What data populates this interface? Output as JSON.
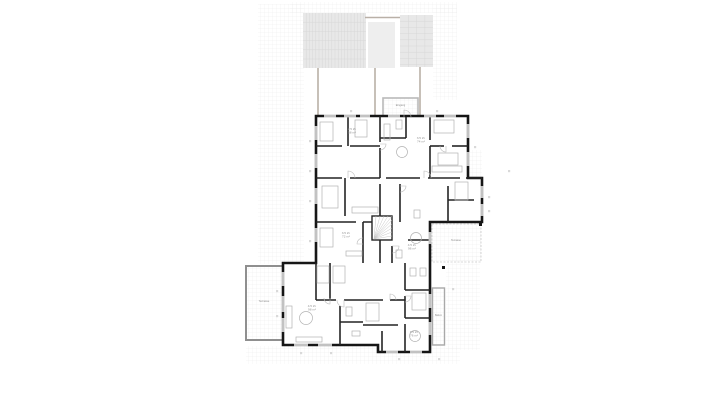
{
  "page": {
    "background": "#ffffff",
    "title": "floor-plan"
  },
  "drawing": {
    "canvas": {
      "width": 721,
      "height": 405
    },
    "colors": {
      "wall": "#161616",
      "interior_wall": "#242424",
      "furniture": "#b3b3b3",
      "paving_line": "#e9e9e9",
      "pergola_fill": "#e8e8e8",
      "pergola_line": "#d7d7d7",
      "pergola_mid_fill": "#eeeeee",
      "support_line": "#b9b0a7",
      "window_line": "#9a9a9a",
      "door_line": "#bbbbbb",
      "label": "#8f8f8f",
      "dim_mark": "#d9d9d9"
    },
    "paving_patches": [
      [
        290,
        2,
        167,
        11
      ],
      [
        258,
        4,
        46,
        260
      ],
      [
        433,
        5,
        24,
        95
      ],
      [
        246,
        346,
        214,
        18
      ],
      [
        446,
        256,
        34,
        94
      ],
      [
        468,
        150,
        14,
        28
      ]
    ],
    "pergolas": [
      {
        "x": 303,
        "y": 13,
        "w": 63,
        "h": 55,
        "vs": 3.2,
        "hs": 9.2
      },
      {
        "x": 368,
        "y": 22,
        "w": 27,
        "h": 46,
        "vs": 0,
        "hs": 0
      },
      {
        "x": 400,
        "y": 15,
        "w": 33,
        "h": 52,
        "vs": 8.3,
        "hs": 6.2
      }
    ],
    "connector_line": [
      365,
      17.5,
      400,
      17.5
    ],
    "support_lines": [
      [
        318,
        68,
        318,
        116
      ],
      [
        375,
        68,
        375,
        118
      ],
      [
        420,
        67,
        420,
        118
      ]
    ],
    "porch": {
      "x": 383,
      "y": 98,
      "w": 35,
      "h": 19
    },
    "terraces": [
      {
        "x": 246,
        "y": 266,
        "w": 37,
        "h": 74,
        "stroke": "#8f8f8f",
        "sw": 2,
        "dash": ""
      },
      {
        "x": 432,
        "y": 224,
        "w": 49,
        "h": 38,
        "stroke": "#cccccc",
        "sw": 0.8,
        "dash": "2 1.5"
      },
      {
        "x": 432.5,
        "y": 288,
        "w": 12,
        "h": 57,
        "stroke": "#a9a9a9",
        "sw": 1.4,
        "dash": ""
      }
    ],
    "footprint": "316,116 468,116 468,178 482,178 482,222 430,222 430,352 378,352 378,345 283,345 283,263 316,263",
    "interior_walls": [
      [
        348,
        116,
        348,
        146
      ],
      [
        316,
        146,
        342,
        146
      ],
      [
        350,
        146,
        380,
        146
      ],
      [
        316,
        178,
        342,
        178
      ],
      [
        350,
        178,
        380,
        178
      ],
      [
        345,
        178,
        345,
        216
      ],
      [
        316,
        222,
        356,
        222
      ],
      [
        363,
        222,
        380,
        222
      ],
      [
        363,
        222,
        363,
        263
      ],
      [
        380,
        116,
        380,
        142
      ],
      [
        380,
        148,
        380,
        178
      ],
      [
        380,
        184,
        380,
        222
      ],
      [
        380,
        228,
        380,
        263
      ],
      [
        406,
        117,
        406,
        138
      ],
      [
        380,
        138,
        406,
        138
      ],
      [
        430,
        117,
        430,
        140
      ],
      [
        430,
        146,
        430,
        178
      ],
      [
        430,
        146,
        444,
        146
      ],
      [
        452,
        146,
        468,
        146
      ],
      [
        386,
        178,
        420,
        178
      ],
      [
        428,
        178,
        460,
        178
      ],
      [
        466,
        178,
        482,
        178
      ],
      [
        400,
        184,
        400,
        222
      ],
      [
        448,
        186,
        448,
        222
      ],
      [
        448,
        200,
        474,
        200
      ],
      [
        392,
        246,
        392,
        263
      ],
      [
        408,
        240,
        430,
        240
      ],
      [
        330,
        263,
        330,
        300
      ],
      [
        316,
        263,
        316,
        300
      ],
      [
        316,
        300,
        336,
        300
      ],
      [
        344,
        300,
        363,
        300
      ],
      [
        340,
        306,
        340,
        345
      ],
      [
        340,
        322,
        363,
        322
      ],
      [
        405,
        263,
        405,
        290
      ],
      [
        405,
        296,
        405,
        318
      ],
      [
        405,
        324,
        405,
        352
      ],
      [
        405,
        290,
        430,
        290
      ],
      [
        405,
        318,
        430,
        318
      ],
      [
        363,
        300,
        383,
        300
      ],
      [
        390,
        300,
        405,
        300
      ],
      [
        363,
        325,
        398,
        325
      ],
      [
        382,
        331,
        382,
        352
      ]
    ],
    "windows": [
      [
        324,
        114.7,
        12,
        2.6
      ],
      [
        344,
        114.7,
        12,
        2.6
      ],
      [
        360,
        114.7,
        10,
        2.6
      ],
      [
        388,
        114.7,
        12,
        2.6
      ],
      [
        424,
        114.7,
        12,
        2.6
      ],
      [
        444,
        114.7,
        12,
        2.6
      ],
      [
        466.7,
        124,
        2.6,
        14
      ],
      [
        466.7,
        152,
        2.6,
        14
      ],
      [
        480.7,
        186,
        2.6,
        12
      ],
      [
        480.7,
        204,
        2.6,
        12
      ],
      [
        314.7,
        126,
        2.6,
        14
      ],
      [
        314.7,
        154,
        2.6,
        14
      ],
      [
        314.7,
        188,
        2.6,
        16
      ],
      [
        314.7,
        228,
        2.6,
        14
      ],
      [
        281.7,
        272,
        2.6,
        14
      ],
      [
        281.7,
        296,
        2.6,
        16
      ],
      [
        281.7,
        318,
        2.6,
        14
      ],
      [
        294,
        343.7,
        14,
        2.6
      ],
      [
        318,
        343.7,
        14,
        2.6
      ],
      [
        386,
        350.7,
        12,
        2.6
      ],
      [
        410,
        350.7,
        12,
        2.6
      ],
      [
        428.7,
        232,
        2.6,
        12
      ],
      [
        428.7,
        294,
        2.6,
        14
      ],
      [
        428.7,
        322,
        2.6,
        13
      ]
    ],
    "doors": [
      [
        348,
        178,
        7,
        0
      ],
      [
        424,
        178,
        7,
        0
      ],
      [
        446,
        146,
        6,
        180
      ],
      [
        400,
        186,
        6,
        90
      ],
      [
        392,
        246,
        7,
        90
      ],
      [
        344,
        300,
        7,
        180
      ],
      [
        390,
        300,
        6,
        0
      ],
      [
        405,
        296,
        6,
        90
      ],
      [
        404,
        117,
        7,
        0
      ],
      [
        363,
        244,
        6,
        270
      ],
      [
        330,
        298,
        6,
        180
      ],
      [
        380,
        144,
        6,
        90
      ]
    ],
    "stair": {
      "x": 372,
      "y": 216,
      "w": 20,
      "h": 24,
      "cx": 374,
      "cy": 239,
      "rays": 10
    },
    "furniture_rects": [
      [
        320,
        122,
        13,
        19
      ],
      [
        355,
        120,
        12,
        17
      ],
      [
        434,
        120,
        20,
        13
      ],
      [
        438,
        153,
        20,
        12
      ],
      [
        322,
        186,
        16,
        22
      ],
      [
        320,
        228,
        13,
        19
      ],
      [
        317,
        266,
        12,
        17
      ],
      [
        333,
        266,
        12,
        17
      ],
      [
        455,
        182,
        13,
        18
      ],
      [
        412,
        293,
        14,
        17
      ],
      [
        366,
        303,
        13,
        18
      ],
      [
        352,
        207,
        26,
        6
      ],
      [
        432,
        166,
        30,
        6
      ],
      [
        346,
        251,
        16,
        5
      ],
      [
        296,
        337,
        26,
        5
      ],
      [
        286,
        306,
        6,
        22
      ],
      [
        384,
        124,
        6,
        16
      ],
      [
        396,
        120,
        6,
        9
      ],
      [
        414,
        210,
        6,
        8
      ],
      [
        396,
        250,
        6,
        8
      ],
      [
        346,
        307,
        6,
        9
      ],
      [
        352,
        331,
        8,
        5
      ],
      [
        410,
        268,
        6,
        8
      ],
      [
        420,
        268,
        6,
        8
      ]
    ],
    "furniture_circles": [
      [
        306,
        318,
        6.5
      ],
      [
        402,
        152,
        5.5
      ],
      [
        416,
        238,
        5.5
      ],
      [
        415,
        336,
        5.5
      ]
    ],
    "posts": [
      [
        442,
        266
      ],
      [
        479,
        223
      ]
    ],
    "dim_marks": [
      [
        309,
        140
      ],
      [
        309,
        170
      ],
      [
        309,
        200
      ],
      [
        309,
        240
      ],
      [
        474,
        146
      ],
      [
        488,
        196
      ],
      [
        488,
        210
      ],
      [
        276,
        290
      ],
      [
        276,
        315
      ],
      [
        300,
        352
      ],
      [
        330,
        352
      ],
      [
        398,
        358
      ],
      [
        438,
        358
      ],
      [
        452,
        288
      ],
      [
        350,
        110
      ],
      [
        436,
        110
      ],
      [
        508,
        170
      ]
    ],
    "room_labels": [
      {
        "x": 352,
        "y": 130,
        "size": 3.1,
        "lines": [
          "2.5 Zi.",
          "58 m²"
        ]
      },
      {
        "x": 421,
        "y": 139,
        "size": 3.1,
        "lines": [
          "3.5 Zi.",
          "74 m²"
        ]
      },
      {
        "x": 346,
        "y": 234,
        "size": 3.1,
        "lines": [
          "3.5 Zi.",
          "72 m²"
        ]
      },
      {
        "x": 412,
        "y": 246,
        "size": 3.1,
        "lines": [
          "4.5 Zi.",
          "96 m²"
        ]
      },
      {
        "x": 312,
        "y": 307,
        "size": 3.1,
        "lines": [
          "4.5 Zi.",
          "98 m²"
        ]
      },
      {
        "x": 414,
        "y": 333,
        "size": 3.1,
        "lines": [
          "3.5 Zi.",
          "76 m²"
        ]
      },
      {
        "x": 400.5,
        "y": 106,
        "size": 2.6,
        "lines": [
          "Eingang"
        ]
      },
      {
        "x": 264,
        "y": 302,
        "size": 2.8,
        "lines": [
          "Terrasse"
        ]
      },
      {
        "x": 456,
        "y": 241,
        "size": 2.6,
        "lines": [
          "Terrasse"
        ]
      },
      {
        "x": 438.5,
        "y": 316,
        "size": 2.3,
        "lines": [
          "Balkon"
        ]
      }
    ]
  }
}
